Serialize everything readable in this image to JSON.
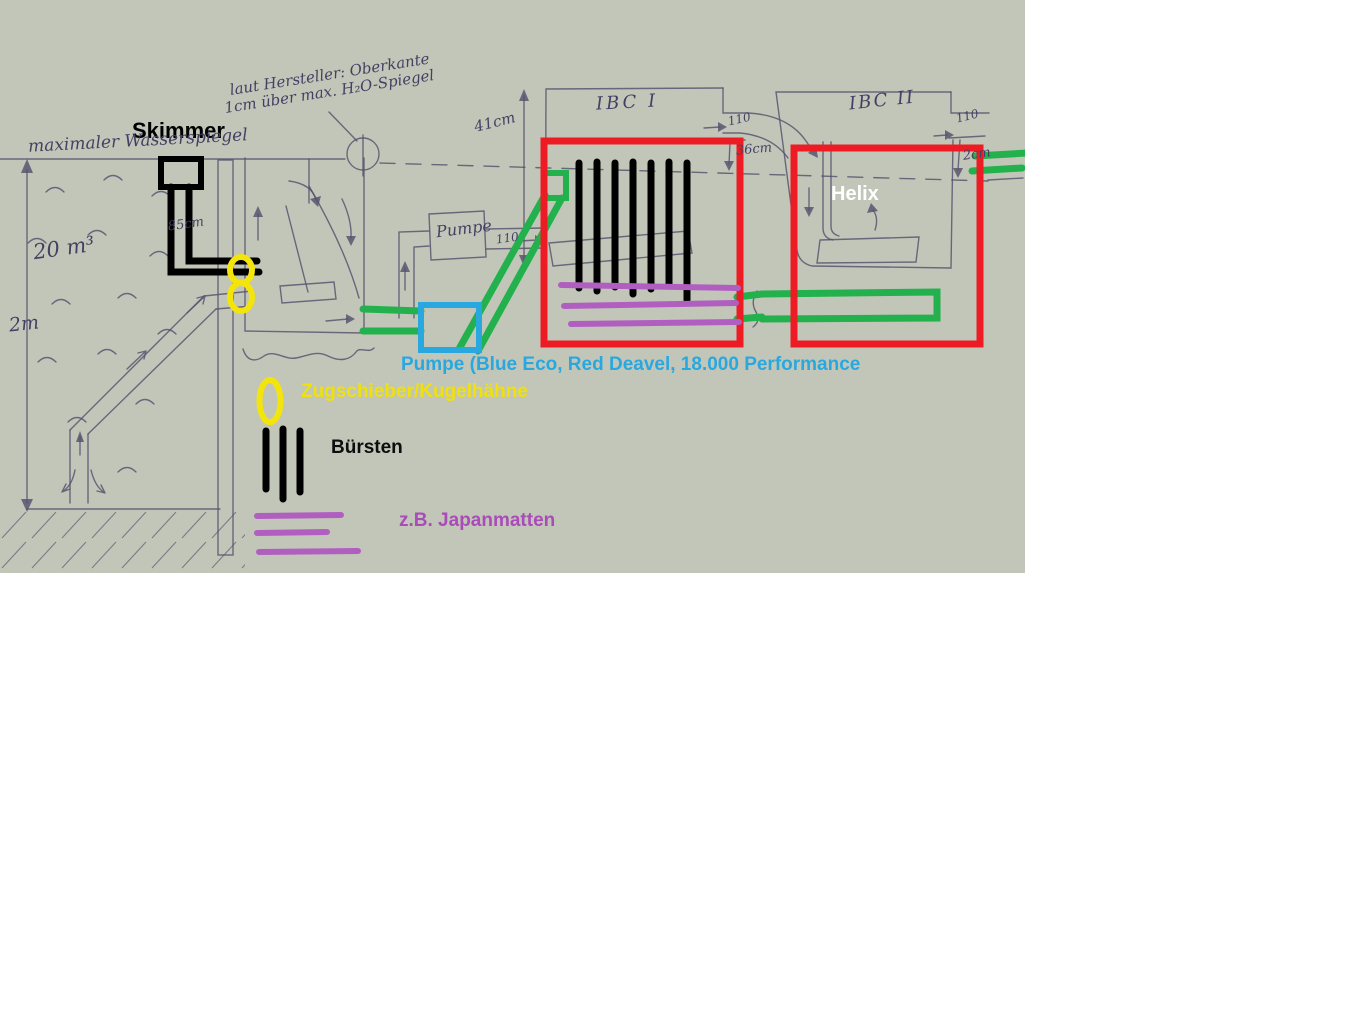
{
  "annotations": {
    "skimmer": "Skimmer",
    "helix": "Helix",
    "pump": "Pumpe (Blue Eco, Red Deavel, 18.000 Performance",
    "valves": "Zugschieber/Kugelhähne",
    "brushes": "Bürsten",
    "mats": "z.B. Japanmatten"
  },
  "handwriting": {
    "note_line1": "laut Hersteller: Oberkante",
    "note_line2": "1cm über max. H₂O-Spiegel",
    "max_water_level": "maximaler Wasserspiegel",
    "pond_volume": "20 m³",
    "pond_depth": "2m",
    "skimmer_depth": "85cm",
    "pump_box": "Pumpe",
    "ibc1": "IBC I",
    "ibc2": "IBC II",
    "ibc_height": "41cm",
    "pipe_dn_pump": "110",
    "pipe_dn_mid": "110",
    "pipe_dn_right": "110",
    "drop_mid": "36cm",
    "drop_right": "2cm"
  },
  "colors": {
    "marker_red": "#ed1c24",
    "marker_green": "#22b14c",
    "marker_blue": "#29a8e0",
    "marker_yellow": "#f3e50c",
    "marker_purple": "#b05fc0",
    "marker_black": "#000000",
    "pencil": "#55506e",
    "paper": "#c2c6b8"
  }
}
